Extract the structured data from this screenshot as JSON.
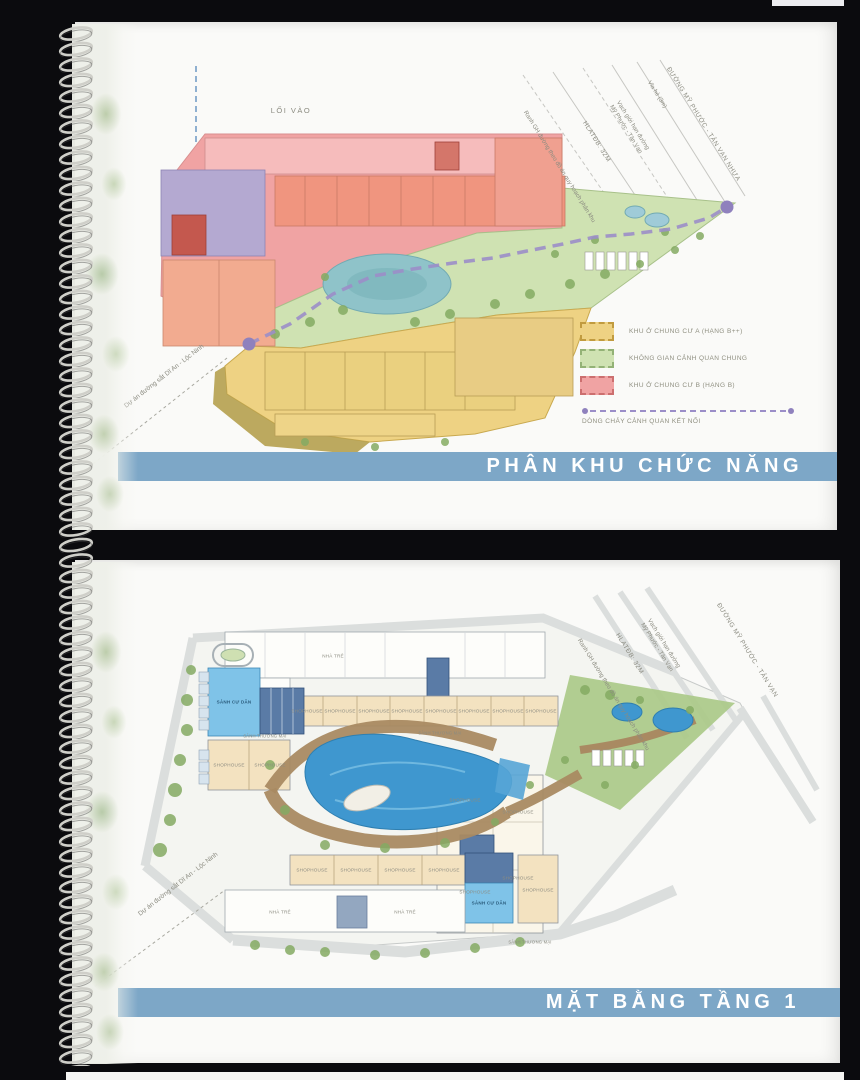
{
  "palette": {
    "background": "#0b0b0e",
    "page": "#fafaf8",
    "title_bar": "#7da7c7",
    "title_text": "#ffffff",
    "zone_a": "#eed283",
    "zone_green": "#cfe2b2",
    "zone_b": "#f0a3a3",
    "lake": "#8fc3c9",
    "pool": "#3f97cf",
    "flow": "#9b8ec8",
    "road": "#dbdedd",
    "brown": "#a98a62",
    "tree": "#85ab63",
    "lobby": "#7fc3e8",
    "core": "#5a7ba6",
    "tan": "#f3e2c0",
    "label": "#8b8b80"
  },
  "page1": {
    "title": "PHÂN KHU CHỨC NĂNG",
    "map": {
      "entry_label": "LỐI VÀO",
      "railway_label": "Dự án đường sắt Dĩ An - Lộc Ninh",
      "streets": {
        "main_road": "ĐƯỜNG MỸ PHƯỚC - TÂN VẠN NHỰA",
        "sidewalk": "Vỉa hè (3m)",
        "road_boundary": "Vạch giới hạn đường Mỹ Phước - Tân Vạn",
        "safety_corridor": "HLATĐB: 32M",
        "planning_boundary": "Ranh GH đường theo đồ án quy hoạch phân khu"
      }
    },
    "legend": {
      "items": [
        {
          "label": "KHU Ở CHUNG CƯ A (HẠNG B++)",
          "color": "#eed283"
        },
        {
          "label": "KHÔNG GIAN CẢNH QUAN CHUNG",
          "color": "#cfe2b2"
        },
        {
          "label": "KHU Ở CHUNG CƯ B (HẠNG B)",
          "color": "#f0a3a3"
        }
      ],
      "flow_label": "DÒNG CHẢY CẢNH QUAN KẾT NỐI"
    }
  },
  "page2": {
    "title": "MẶT BẰNG TẦNG 1",
    "map": {
      "railway_label": "Dự án đường sắt Dĩ An - Lộc Ninh",
      "streets": {
        "main_road": "ĐƯỜNG MỸ PHƯỚC - TÂN VẠN",
        "road_boundary": "Vạch giới hạn đường Mỹ Phước - Tân Vạn",
        "safety_corridor": "HLATĐB: 32M",
        "planning_boundary": "Ranh GH đường theo đồ án quy hoạch phân khu"
      },
      "building_labels": {
        "nursery": "NHÀ TRẺ",
        "shophouse": "SHOPHOUSE",
        "resident_lobby": "SẢNH CƯ DÂN",
        "commercial_lobby": "SẢNH THƯƠNG MẠI"
      }
    }
  }
}
